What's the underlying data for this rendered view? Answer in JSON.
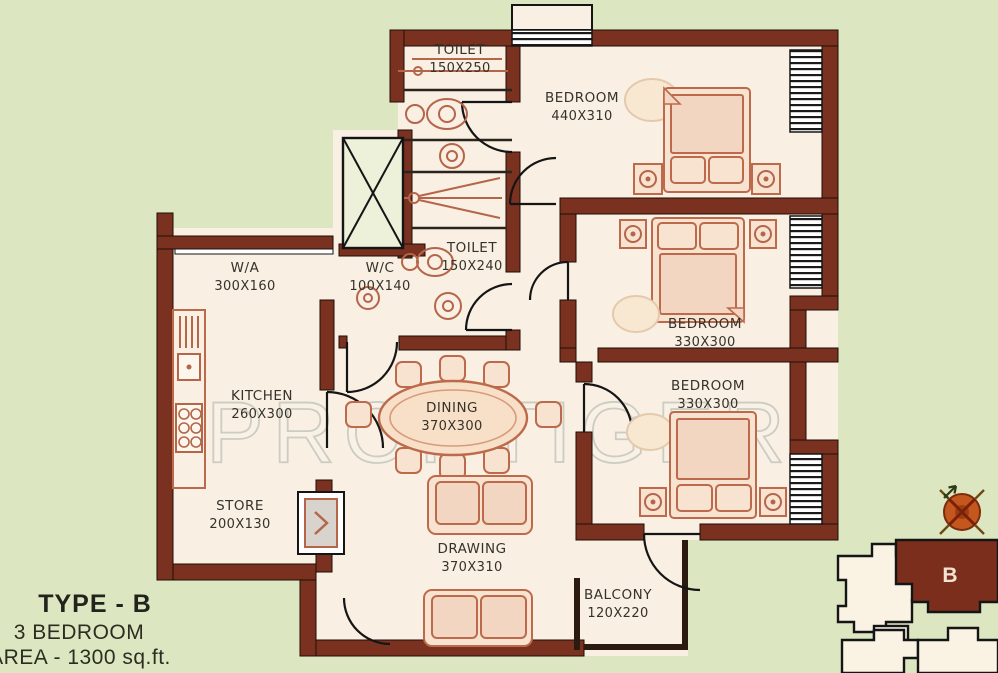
{
  "title_block": {
    "type_label": "TYPE - B",
    "bedrooms_label": "3 BEDROOM",
    "area_label": "AREA - 1300 sq.ft."
  },
  "watermark": "PROPTIGER",
  "rooms": {
    "toilet_ensuite": {
      "name": "TOILET",
      "dims": "150X250"
    },
    "bedroom_master": {
      "name": "BEDROOM",
      "dims": "440X310"
    },
    "wa": {
      "name": "W/A",
      "dims": "300X160"
    },
    "wc": {
      "name": "W/C",
      "dims": "100X140"
    },
    "toilet_common": {
      "name": "TOILET",
      "dims": "150X240"
    },
    "bedroom_mid": {
      "name": "BEDROOM",
      "dims": "330X300"
    },
    "bedroom_lower": {
      "name": "BEDROOM",
      "dims": "330X300"
    },
    "kitchen": {
      "name": "KITCHEN",
      "dims": "260X300"
    },
    "dining": {
      "name": "DINING",
      "dims": "370X300"
    },
    "store": {
      "name": "STORE",
      "dims": "200X130"
    },
    "drawing": {
      "name": "DRAWING",
      "dims": "370X310"
    },
    "balcony": {
      "name": "BALCONY",
      "dims": "120X220"
    }
  },
  "keymap": {
    "unit_label": "B"
  },
  "colors": {
    "background": "#dce7c1",
    "floor": "#f9efe3",
    "wall": "#7b3120",
    "furniture": "#bd6a4c",
    "keymap_highlight": "#7b2e1c"
  }
}
